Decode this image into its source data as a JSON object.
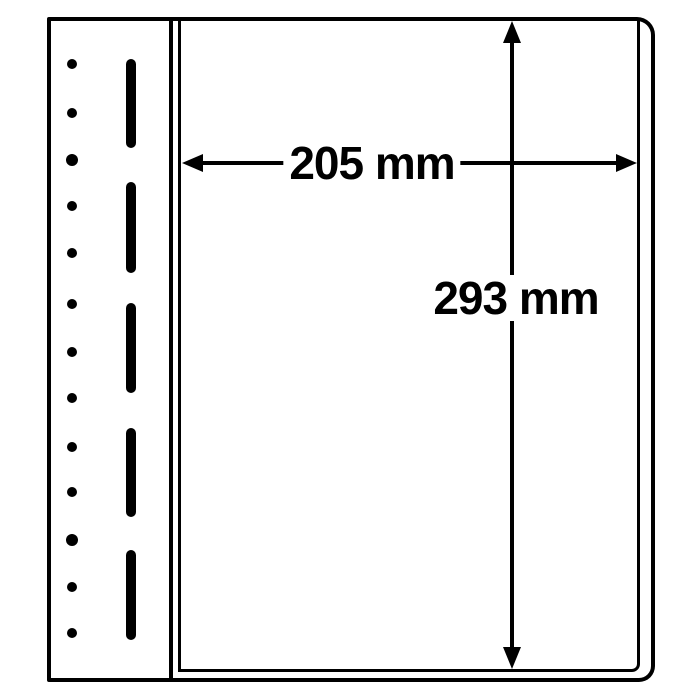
{
  "labels": {
    "width": "205 mm",
    "height": "293 mm"
  },
  "colors": {
    "line": "#000000",
    "background": "#ffffff"
  },
  "binding_strip": {
    "hole_count": 13,
    "slot_count": 5,
    "holes": [
      {
        "cx": 72,
        "cy": 64,
        "r": 5
      },
      {
        "cx": 72,
        "cy": 113,
        "r": 5
      },
      {
        "cx": 72,
        "cy": 160,
        "r": 6
      },
      {
        "cx": 72,
        "cy": 206,
        "r": 5
      },
      {
        "cx": 72,
        "cy": 253,
        "r": 5
      },
      {
        "cx": 72,
        "cy": 304,
        "r": 5
      },
      {
        "cx": 72,
        "cy": 352,
        "r": 5
      },
      {
        "cx": 72,
        "cy": 398,
        "r": 5
      },
      {
        "cx": 72,
        "cy": 447,
        "r": 5
      },
      {
        "cx": 72,
        "cy": 492,
        "r": 5
      },
      {
        "cx": 72,
        "cy": 540,
        "r": 6
      },
      {
        "cx": 72,
        "cy": 587,
        "r": 5
      },
      {
        "cx": 72,
        "cy": 633,
        "r": 5
      }
    ],
    "slots": [
      {
        "y": 59,
        "h": 89
      },
      {
        "y": 182,
        "h": 91
      },
      {
        "y": 303,
        "h": 90
      },
      {
        "y": 428,
        "h": 89
      },
      {
        "y": 550,
        "h": 90
      }
    ]
  }
}
